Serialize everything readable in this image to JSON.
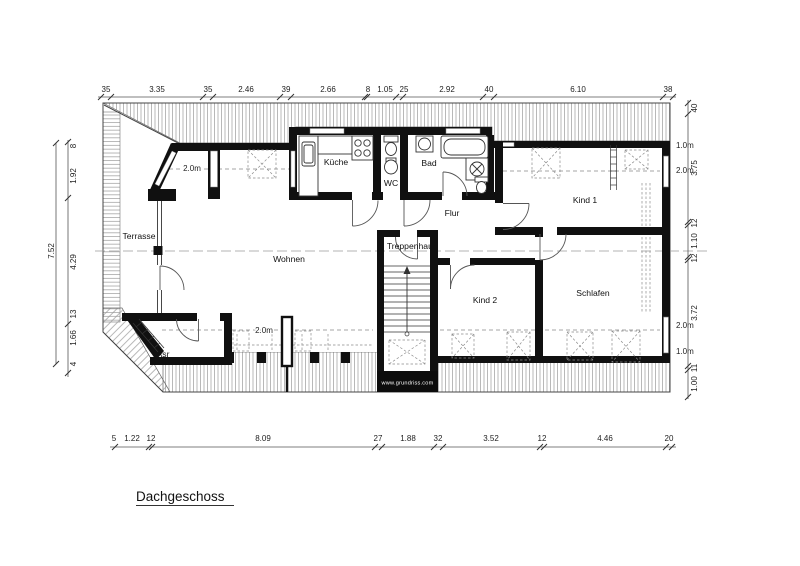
{
  "title": {
    "label": "Dachgeschoss"
  },
  "watermark": "www.grundriss.com",
  "rooms": {
    "terrasse": "Terrasse",
    "wohnen": "Wohnen",
    "kueche": "Küche",
    "wc": "WC",
    "bad": "Bad",
    "flur": "Flur",
    "treppenhaus": "Treppenhaus",
    "kind1": "Kind 1",
    "kind2": "Kind 2",
    "schlafen": "Schlafen",
    "asr": "Asr"
  },
  "height_labels": {
    "alcove": "2.0m",
    "bottom_center": "2.0m",
    "right_margin": [
      "1.0m",
      "2.0m",
      "2.0m",
      "1.0m"
    ]
  },
  "dimensions": {
    "top": [
      "35",
      "3.35",
      "35",
      "2.46",
      "39",
      "2.66",
      "8",
      "1.05",
      "25",
      "2.92",
      "40",
      "6.10",
      "38"
    ],
    "bottom": [
      "5",
      "1.22",
      "12",
      "8.09",
      "27",
      "1.88",
      "32",
      "3.52",
      "12",
      "4.46",
      "20"
    ],
    "left": [
      "8",
      "1.92",
      "4.29",
      "13",
      "1.66",
      "4"
    ],
    "left_overall": "7.52",
    "right": [
      "40",
      "3.75",
      "12",
      "1.10",
      "12",
      "3.72",
      "11",
      "1.00"
    ]
  },
  "colors": {
    "wall": "#101010",
    "hatch": "#9a9a9a",
    "background": "#ffffff"
  }
}
